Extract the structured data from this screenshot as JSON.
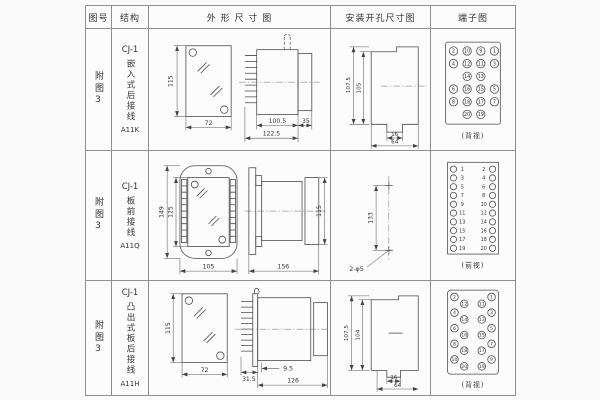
{
  "colors": {
    "grid": "#8f8f8f",
    "line": "#4a4a4a",
    "text": "#333333",
    "bg": "#fafafa"
  },
  "header": {
    "fig": "图号",
    "struct": "结构",
    "outline": "外 形 尺 寸 图",
    "mounting": "安装开孔尺寸图",
    "terminal": "端子图"
  },
  "rows": [
    {
      "fig_no": "附图3",
      "series": "CJ-1",
      "structure": "嵌入式后接线",
      "model": "A11K",
      "outline": {
        "front_h": "115",
        "front_w": "72",
        "body_d": "100.5",
        "total_d": "122.5",
        "flange_d": "35"
      },
      "mounting": {
        "outer_h": "107.5",
        "inner_h": "105",
        "notch_w": "16",
        "span_w": "64"
      },
      "terminal": {
        "view": "(背视)",
        "numbers": [
          "2",
          "10",
          "9",
          "1",
          "4",
          "12",
          "11",
          "3",
          "14",
          "13",
          "6",
          "16",
          "15",
          "5",
          "8",
          "18",
          "17",
          "7",
          "20",
          "19"
        ]
      }
    },
    {
      "fig_no": "附图3",
      "series": "CJ-1",
      "structure": "板前接线",
      "model": "A11Q",
      "outline": {
        "front_outer_h": "149",
        "front_inner_h": "125",
        "front_w": "105",
        "side_d": "156",
        "side_h": "115"
      },
      "mounting": {
        "hole_pitch": "133",
        "hole_label": "2-φ5"
      },
      "terminal": {
        "view": "(前视)",
        "left": [
          "1",
          "3",
          "5",
          "7",
          "9",
          "11",
          "13",
          "15",
          "17",
          "19"
        ],
        "right": [
          "2",
          "4",
          "6",
          "8",
          "10",
          "12",
          "14",
          "16",
          "18",
          "20"
        ]
      }
    },
    {
      "fig_no": "附图3",
      "series": "CJ-1",
      "structure": "凸出式板后接线",
      "model": "A11H",
      "outline": {
        "front_h": "115",
        "front_w": "72",
        "pin_d": "31.5",
        "gap_d": "9.5",
        "body_d": "126"
      },
      "mounting": {
        "outer_h": "107.5",
        "inner_h": "104",
        "notch_w": "16",
        "span_w": "64"
      },
      "terminal": {
        "view": "(背视)",
        "outer_left": [
          "2",
          "4",
          "6",
          "8",
          "10"
        ],
        "inner_left": [
          "12",
          "14",
          "16",
          "18",
          "20"
        ],
        "inner_right": [
          "11",
          "13",
          "15",
          "17",
          "19"
        ],
        "outer_right": [
          "1",
          "3",
          "5",
          "7",
          "9"
        ]
      }
    }
  ]
}
